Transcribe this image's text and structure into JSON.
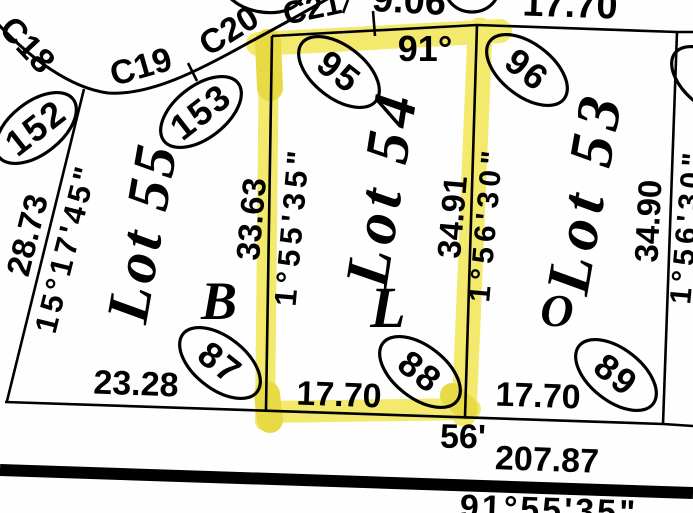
{
  "map": {
    "type": "plat-survey-map",
    "highlighted_lot": "Lot 54",
    "colors": {
      "ink": "#000000",
      "paper": "#fefefe",
      "highlight": "#f3e96c",
      "highlight_dark": "#e8da45"
    },
    "labels": {
      "c18": "C18",
      "c19": "C19",
      "c20": "C20",
      "c21": "C21",
      "dist_906": "9.06",
      "dist_1770_top": "17.70",
      "angle_91": "91°",
      "dist_2873": "28.73",
      "bearing_151745": "15°17'45\"",
      "lot55": "Lot 55",
      "lot54": "Lot 54",
      "lot53": "Lot 53",
      "dist_3363": "33.63",
      "bearing_15535": "1°55'35\"",
      "dist_3491": "34.91",
      "bearing_15630_mid": "1°56'30\"",
      "dist_3490": "34.90",
      "bearing_15630_right": "1°56'30\"",
      "block_b": "B",
      "block_l": "L",
      "block_o": "O",
      "pin_152": "152",
      "pin_153": "153",
      "pin_95": "95",
      "pin_96": "96",
      "pin_87": "87",
      "pin_88": "88",
      "pin_89": "89",
      "dist_2328": "23.28",
      "dist_1770_lot54": "17.70",
      "dist_1770_lot53": "17.70",
      "road_width_56": "56'",
      "dist_20787": "207.87",
      "bearing_915535": "91°55'35\""
    }
  }
}
